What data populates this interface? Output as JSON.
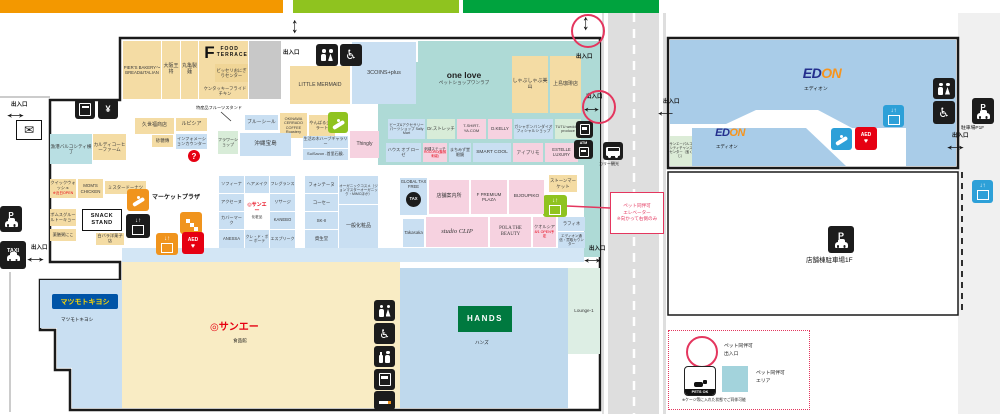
{
  "palette": {
    "bar_orange": "#f39800",
    "bar_light_green": "#8fc31f",
    "bar_green": "#00a33e",
    "pet_area_teal": "#aedad6",
    "store_tan": "#f4dca4",
    "store_blue": "#c9dff2",
    "store_pink": "#f6d2e0",
    "aed_red": "#e60012",
    "pet_red": "#e4365e",
    "edion_blue": "#a9cce8"
  },
  "signs": {
    "entrance": "出入口",
    "market_plaza": "マーケットプラザ",
    "pet_elevator_note": [
      "ペット同伴可",
      "エレベーター",
      "※向かって右側のみ"
    ],
    "bus_stop": "カリー観光",
    "parking_p1f": "駐車場P1F",
    "store_parking": "店舗棟駐車場1F",
    "aed": "AED",
    "atm": "ATM",
    "tax": "TAX",
    "taxi": "TAXI",
    "p": "P",
    "question": "?"
  },
  "legend": {
    "pet_entrance_l1": "ペット同伴可",
    "pet_entrance_l2": "出入口",
    "pet_area_l1": "ペット同伴可",
    "pet_area_l2": "エリア",
    "pets_ok": "PETS OK",
    "note": "※ケージ等に入れた状態でご同伴可能"
  },
  "stores": {
    "piers_bakery": "PIER'S BAKERY～BREAD&ITALIAN",
    "osaka_ohsho": "大阪王将",
    "marugame_seimen": "丸亀製麺",
    "food_terrace_f": "F",
    "food_terrace": "FOOD TERRACE",
    "bisseri_onigiri": "ビッセリおにぎりセンター",
    "kfc": "ケンタッキーフライドチキン",
    "little_mermaid": "LITTLE MERMAID",
    "three_coins": "3COINS+plus",
    "one_love": "one love",
    "one_love_sub": "ペットショップワンラブ",
    "shabushabu_miyama": "しゃぶしゃぶ美山",
    "ueshima_coffee": "上島珈琲店",
    "gyoko_bar": "漁港バルコシティ横丁",
    "kaldi": "カルディコーヒーファーム",
    "kuzefuku": "久世福商店",
    "lupicia": "ルピシア",
    "sato_den": "砂糖傳",
    "information": "インフォメーションカウンター",
    "quick_wash": "クイックウォッシュ",
    "quick_wash_note": "※近日OPEN",
    "moms_chicken": "MOM'S CHICKEN",
    "mister_donut": "ミスタードーナツ",
    "poms_gurule": "ポムスグルールトーキョー",
    "yakuzen_kayu": "薬膳粥にこ",
    "snack_stand": "SNACK STAND",
    "shirobara": "白バラ洋菓子店",
    "fruit_stand": "特産品フルーツスタンド",
    "blue_seal": "ブルーシール",
    "cerrado": "OKINAWA CERRADO COFFEE Roastery",
    "yanbaru_gelato": "やんばるジェラート",
    "flower_shop": "フラワーショップ",
    "okinawa_takarajima": "沖縄宝島",
    "seikatsunoki": "生活の木ハーブギャラリー",
    "suisavon": "SuiSavon -首里石鹸-",
    "thingly": "Thingly",
    "sally_mart": "ビーズ&アクセサリーパーツショップ Sally Mart",
    "dr_stretch": "Dr.ストレッチ",
    "tshirtya": "T-SHIRT-YA.COM",
    "dkelly": "D.KELLY",
    "gashapon_bandai": "ガシャポンバンダイオフィシャルショップ",
    "tutu_wedding": "TUTU wedding produce",
    "house_of_rose": "ハウス オブ ローゼ",
    "shishu_stitch": "刺繍ステッチ",
    "shishu_stitch_sub": "ROCORO(機械刺繍)",
    "machimizu_glasses": "まちみず堂眼鏡",
    "smart_cool": "SMART COOL",
    "iprimo": "アイプリモ",
    "estelle_luxury": "ESTELLE LUXURY",
    "stone_market": "ストーンマーケット",
    "global_tax_free": "GLOBAL TAX FREE",
    "store_guide": "店舗案内所",
    "f_premium_plaza": "F PREMIUM PLAZA",
    "bijoupiko": "BIJOUPIKO",
    "takasaka": "Takasaka",
    "studio_clip": "studio CLIP",
    "pola": "POLA THE BEAUTY",
    "quolcia": "クオルシア",
    "quolcia_note": "8/1 OPEN予定",
    "raffine": "ラフィネ",
    "edion_counter": "エディオン通信・買取カウンター",
    "cosme": {
      "c1": [
        "ソフィーナ",
        "アクセーヌ",
        "カバーマーク",
        "ANESSA"
      ],
      "c2a": "ヘアメイク",
      "c2c": "クレ・ド・ポー ボーテ",
      "c3": [
        "フレグランス",
        "リサージ",
        "KANEBO",
        "エスプリーク"
      ],
      "r1": [
        "フォンテーヌ",
        "コーセー",
        "SK-II",
        "資生堂"
      ],
      "organic": "オーガニックコスメ（ジョンマスターオーガニック・MIMCほか）",
      "general": "一般化粧品"
    },
    "sanei_logo": "◎サンエー",
    "sanei_cosme_caption": "化粧品",
    "sanei_food_caption": "食品館",
    "matsukiyo_logo": "マツモトキヨシ",
    "matsukiyo_caption": "マツモトキヨシ",
    "hands_logo": "HANDS",
    "hands_caption": "ハンズ",
    "lounge": "Lounge-1",
    "edion_logo_ed": "ED",
    "edion_logo_on": "ON",
    "edion_caption": "エディオン",
    "chance_center": "サンエーパルコシティチャンスセンター（宝くじ）"
  }
}
